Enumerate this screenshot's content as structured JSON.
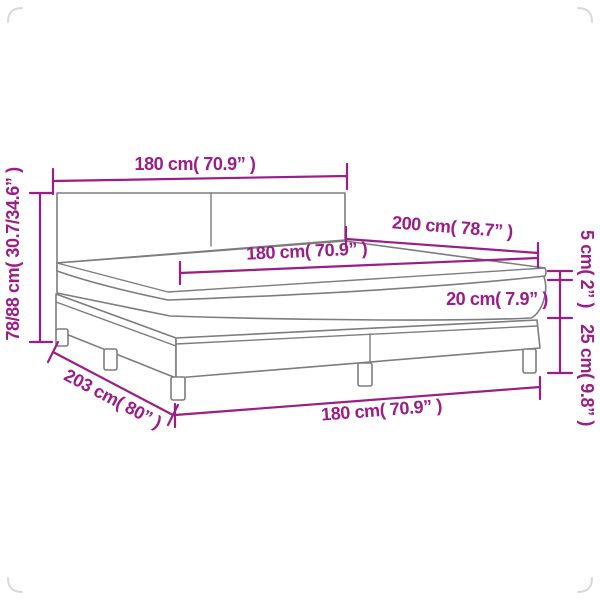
{
  "diagram": {
    "type": "product-dimension-diagram",
    "subject": "box-spring-bed-with-mattress-and-topper",
    "background_color": "#ffffff",
    "accent_color": "#9b1d87",
    "outline_color": "#7d7d7d",
    "labels": {
      "headboard_width": "180 cm( 70.9” )",
      "headboard_height": "78/88 cm( 30.7/34.6” )",
      "bed_length": "200 cm( 78.7” )",
      "mattress_width": "180 cm( 70.9” )",
      "topper_thickness": "5 cm( 2” )",
      "mattress_thickness": "20 cm( 7.9” )",
      "base_height": "25 cm( 9.8” )",
      "bed_depth": "203 cm( 80” )",
      "base_width": "180 cm( 70.9” )"
    }
  }
}
